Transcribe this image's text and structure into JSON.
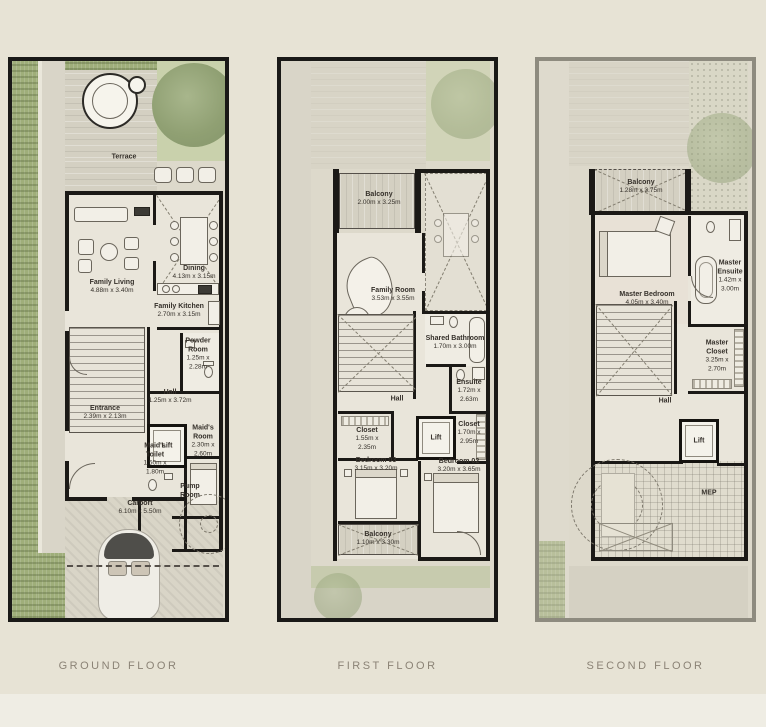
{
  "colors": {
    "background": "#e7e3d5",
    "plot": "#ddd9cb",
    "wall": "#1b1916",
    "greenery": "#9fae7a",
    "caption_text": "#8b8376"
  },
  "floors": [
    {
      "caption": "GROUND FLOOR",
      "rooms": [
        {
          "name": "Terrace",
          "dims": ""
        },
        {
          "name": "Family Living",
          "dims": "4.88m x 3.40m"
        },
        {
          "name": "Dining",
          "dims": "4.13m x 3.15m"
        },
        {
          "name": "Family Kitchen",
          "dims": "2.70m x 3.15m"
        },
        {
          "name": "Powder Room",
          "dims": "1.25m x 2.28m"
        },
        {
          "name": "Hall",
          "dims": "1.25m x 3.72m"
        },
        {
          "name": "Entrance",
          "dims": "2.39m x 2.13m"
        },
        {
          "name": "Lift",
          "dims": ""
        },
        {
          "name": "Maid's Room",
          "dims": "2.30m x 2.60m"
        },
        {
          "name": "Maid's Toilet",
          "dims": "1.50m x 1.80m"
        },
        {
          "name": "Pump Room",
          "dims": ""
        },
        {
          "name": "Carport",
          "dims": "6.10m x 5.50m"
        }
      ]
    },
    {
      "caption": "FIRST FLOOR",
      "rooms": [
        {
          "name": "Balcony",
          "dims": "2.00m x 3.25m"
        },
        {
          "name": "Family Room",
          "dims": "3.53m x 3.55m"
        },
        {
          "name": "Shared Bathroom",
          "dims": "1.70m x 3.00m"
        },
        {
          "name": "Ensuite",
          "dims": "1.72m x 2.63m"
        },
        {
          "name": "Hall",
          "dims": ""
        },
        {
          "name": "Closet",
          "dims": "1.55m x 2.35m"
        },
        {
          "name": "Lift",
          "dims": ""
        },
        {
          "name": "Closet",
          "dims": "1.70m x 2.95m"
        },
        {
          "name": "Bedroom 03",
          "dims": "3.15m x 3.20m"
        },
        {
          "name": "Bedroom 02",
          "dims": "3.20m x 3.65m"
        },
        {
          "name": "Balcony",
          "dims": "1.10m x 3.30m"
        }
      ]
    },
    {
      "caption": "SECOND FLOOR",
      "rooms": [
        {
          "name": "Balcony",
          "dims": "1.28m x 3.75m"
        },
        {
          "name": "Master Bedroom",
          "dims": "4.05m x 3.40m"
        },
        {
          "name": "Master Ensuite",
          "dims": "1.42m x 3.00m"
        },
        {
          "name": "Master Closet",
          "dims": "3.25m x 2.70m"
        },
        {
          "name": "Hall",
          "dims": ""
        },
        {
          "name": "Lift",
          "dims": ""
        },
        {
          "name": "MEP",
          "dims": ""
        }
      ]
    }
  ]
}
